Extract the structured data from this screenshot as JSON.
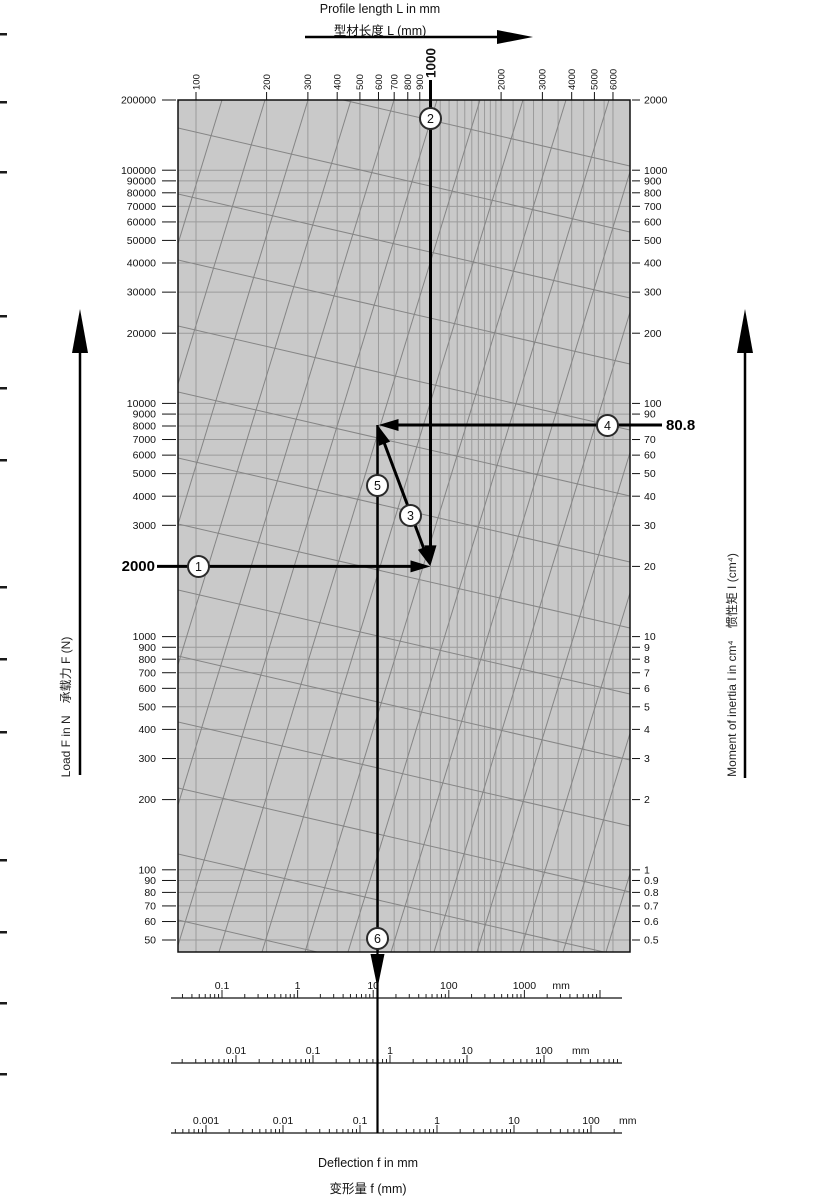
{
  "chart_data": {
    "type": "line",
    "variant": "nomogram-deflection",
    "title": "Profile length L in mm",
    "title_zh": "型材长度 L (mm)",
    "grid": true,
    "legend": false,
    "colors": {
      "plot_bg": "#c9c9c9",
      "grid": "#9b9b9b",
      "diagonal": "#858585",
      "ink": "#000000"
    },
    "axes": {
      "top": {
        "label": "Profile length L in mm",
        "label_zh": "型材长度 L (mm)",
        "unit": "mm",
        "scale": "log",
        "range": [
          100,
          6000
        ],
        "ticks": [
          "100",
          "200",
          "300",
          "400",
          "500",
          "600",
          "700",
          "800",
          "900",
          "2000",
          "3000",
          "4000",
          "5000",
          "6000"
        ]
      },
      "left": {
        "label": "Load F in N",
        "label_zh": "承载力 F (N)",
        "label_full": "Load F in N　承载力 F (N)",
        "unit": "N",
        "scale": "log",
        "range": [
          50,
          200000
        ],
        "ticks": [
          "200000",
          "100000",
          "90000",
          "80000",
          "70000",
          "60000",
          "50000",
          "40000",
          "30000",
          "20000",
          "10000",
          "9000",
          "8000",
          "7000",
          "6000",
          "5000",
          "4000",
          "3000",
          "1000",
          "900",
          "800",
          "700",
          "600",
          "500",
          "400",
          "300",
          "200",
          "100",
          "90",
          "80",
          "70",
          "60",
          "50"
        ]
      },
      "right": {
        "label": "Moment of inertia I in cm⁴",
        "label_zh": "惯性矩 I (cm⁴)",
        "label_full": "Moment of inertia I in cm⁴　惯性矩 I (cm⁴)",
        "unit": "cm⁴",
        "scale": "log",
        "range": [
          0.5,
          2000
        ],
        "ticks": [
          "2000",
          "1000",
          "900",
          "800",
          "700",
          "600",
          "500",
          "400",
          "300",
          "200",
          "100",
          "90",
          "70",
          "60",
          "50",
          "40",
          "30",
          "20",
          "10",
          "9",
          "8",
          "7",
          "6",
          "5",
          "4",
          "3",
          "2",
          "1",
          "0.9",
          "0.8",
          "0.7",
          "0.6",
          "0.5"
        ]
      },
      "bottom": {
        "label": "Deflection f in mm",
        "label_zh": "变形量 f (mm)",
        "unit": "mm",
        "scales": [
          {
            "labels": [
              "0.1",
              "1",
              "10",
              "100",
              "1000"
            ],
            "unit": "mm"
          },
          {
            "labels": [
              "0.01",
              "0.1",
              "1",
              "10",
              "100"
            ],
            "unit": "mm"
          },
          {
            "labels": [
              "0.001",
              "0.01",
              "0.1",
              "1",
              "10",
              "100"
            ],
            "unit": "mm"
          }
        ]
      }
    },
    "example": {
      "load_N": "2000",
      "length_mm": "1000",
      "inertia_cm4": "80.8",
      "steps": [
        "1",
        "2",
        "3",
        "4",
        "5",
        "6"
      ]
    }
  }
}
